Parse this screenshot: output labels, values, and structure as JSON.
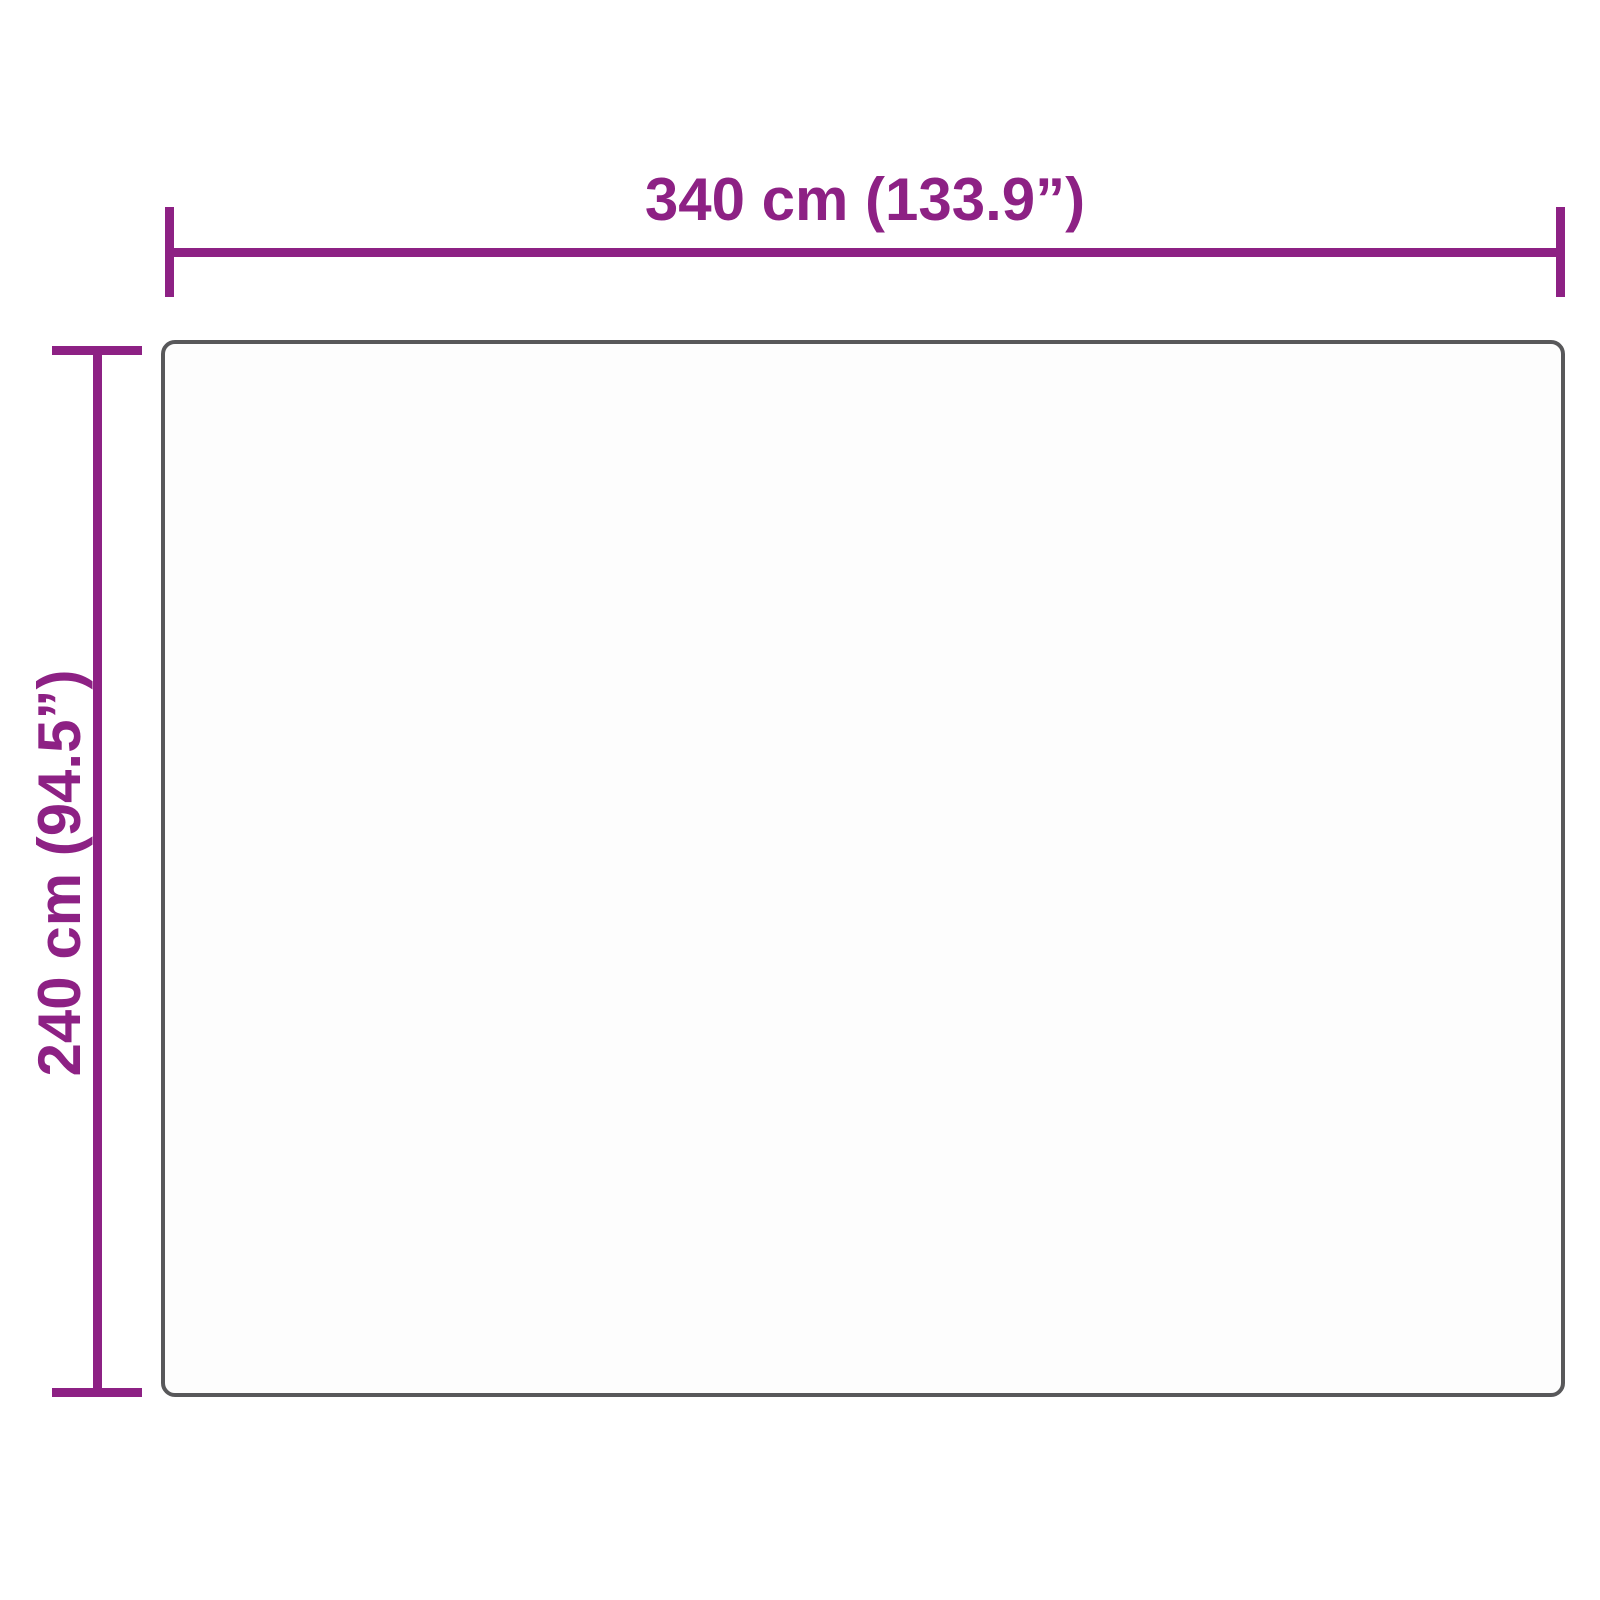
{
  "diagram": {
    "type": "product-dimension-diagram",
    "width_dimension": {
      "label": "340 cm (133.9”)",
      "cm": 340,
      "inches": 133.9
    },
    "height_dimension": {
      "label": "240 cm (94.5”)",
      "cm": 240,
      "inches": 94.5
    },
    "colors": {
      "accent": "#8d2184",
      "outline": "#58585a",
      "background": "#ffffff",
      "product_fill": "#fdfdfd"
    }
  }
}
